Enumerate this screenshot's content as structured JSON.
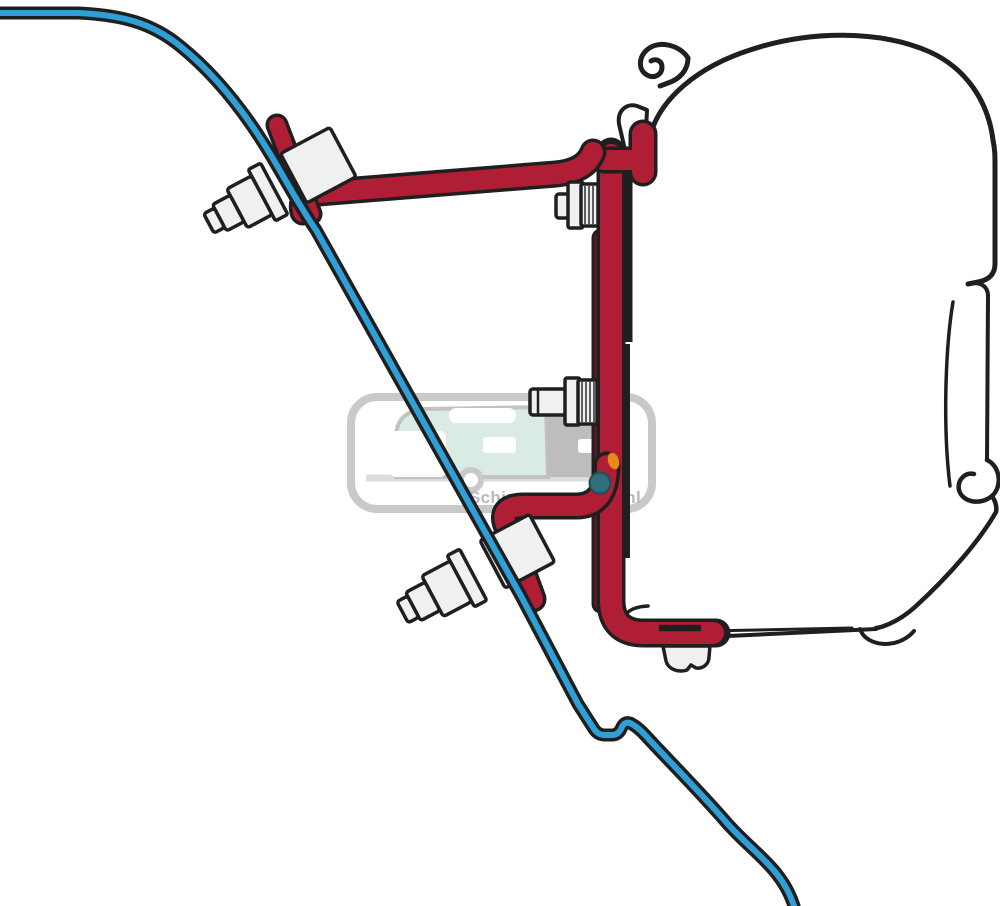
{
  "page": {
    "title": "Awning adapter bracket mounting diagram",
    "background": "#ffffff"
  },
  "watermark": {
    "text": "Schippercaravans.nl",
    "border_gray": "#c9c9c9",
    "ground_gray": "#dcdcdc",
    "caravan_mint": "#d9ebe3",
    "caravan_gray": "#bdbdbd",
    "window_white": "#ffffff",
    "wheel_ring_gray": "#c9c9c9",
    "wheel_teal": "#2f6f7b",
    "detail_orange": "#e8891a",
    "text_gray": "#b9b9b9"
  },
  "colors": {
    "outline_black": "#1f1f1f",
    "roof_blue": "#2f9fd6",
    "bracket_red": "#b01e36",
    "bracket_dark_red": "#701427",
    "hardware_fill": "#f0f0f0",
    "case_white": "#ffffff"
  }
}
